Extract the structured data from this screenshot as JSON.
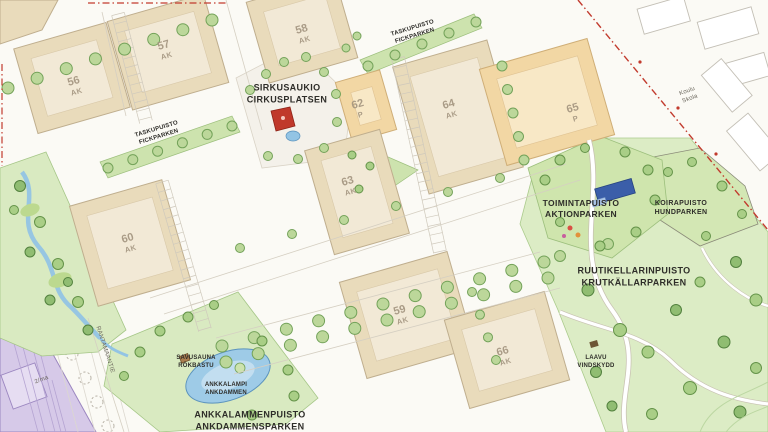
{
  "map": {
    "labels": {
      "sirkusaukio": {
        "fi": "SIRKUSAUKIO",
        "sv": "CIRKUSPLATSEN"
      },
      "taskupuisto_west": {
        "fi": "TASKUPUISTO",
        "sv": "FICKPARKEN"
      },
      "taskupuisto_north": {
        "fi": "TASKUPUISTO",
        "sv": "FICKPARKEN"
      },
      "toimintapuisto": {
        "fi": "TOIMINTAPUISTO",
        "sv": "AKTIONPARKEN"
      },
      "koirapuisto": {
        "fi": "KOIRAPUISTO",
        "sv": "HUNDPARKEN"
      },
      "ruutikellarinpuisto": {
        "fi": "RUUTIKELLARINPUISTO",
        "sv": "KRUTKÄLLARPARKEN"
      },
      "ankkalammenpuisto": {
        "fi": "ANKKALAMMENPUISTO",
        "sv": "ANKDAMMENSPARKEN"
      },
      "ankkalampi": {
        "fi": "ANKKALAMPI",
        "sv": "ANKDAMMEN"
      },
      "savusauna": {
        "fi": "SAVUSAUNA",
        "sv": "RÖKBASTU"
      },
      "laavu": {
        "fi": "LAAVU",
        "sv": "VINDSKYDD"
      },
      "koulu": {
        "fi": "Koulu",
        "sv": "Skola"
      },
      "street_name": "RANTAMAANTIE",
      "annotation_2ma": "2/ma"
    },
    "blocks": [
      {
        "number": "56",
        "code": "AK"
      },
      {
        "number": "57",
        "code": "AK"
      },
      {
        "number": "58",
        "code": "AK"
      },
      {
        "number": "60",
        "code": "AK"
      },
      {
        "number": "62",
        "code": "P"
      },
      {
        "number": "63",
        "code": "AK"
      },
      {
        "number": "64",
        "code": "AK"
      },
      {
        "number": "65",
        "code": "P"
      },
      {
        "number": "59",
        "code": "AK"
      },
      {
        "number": "66",
        "code": "AK"
      }
    ],
    "colors": {
      "block_beige": "#e9dbbb",
      "block_courtyard": "#f2e9d6",
      "block_orange": "#f2d7a4",
      "orange_courtyard": "#f8e8c6",
      "park_green": "#dcecc5",
      "strip_green": "#cde3ae",
      "water_blue": "#93c4e4",
      "boundary_red": "#c23b2e",
      "reserve_lavender": "#d6c9e8",
      "building_blue": "#3b5ea9",
      "feature_red": "#c0392b"
    }
  }
}
